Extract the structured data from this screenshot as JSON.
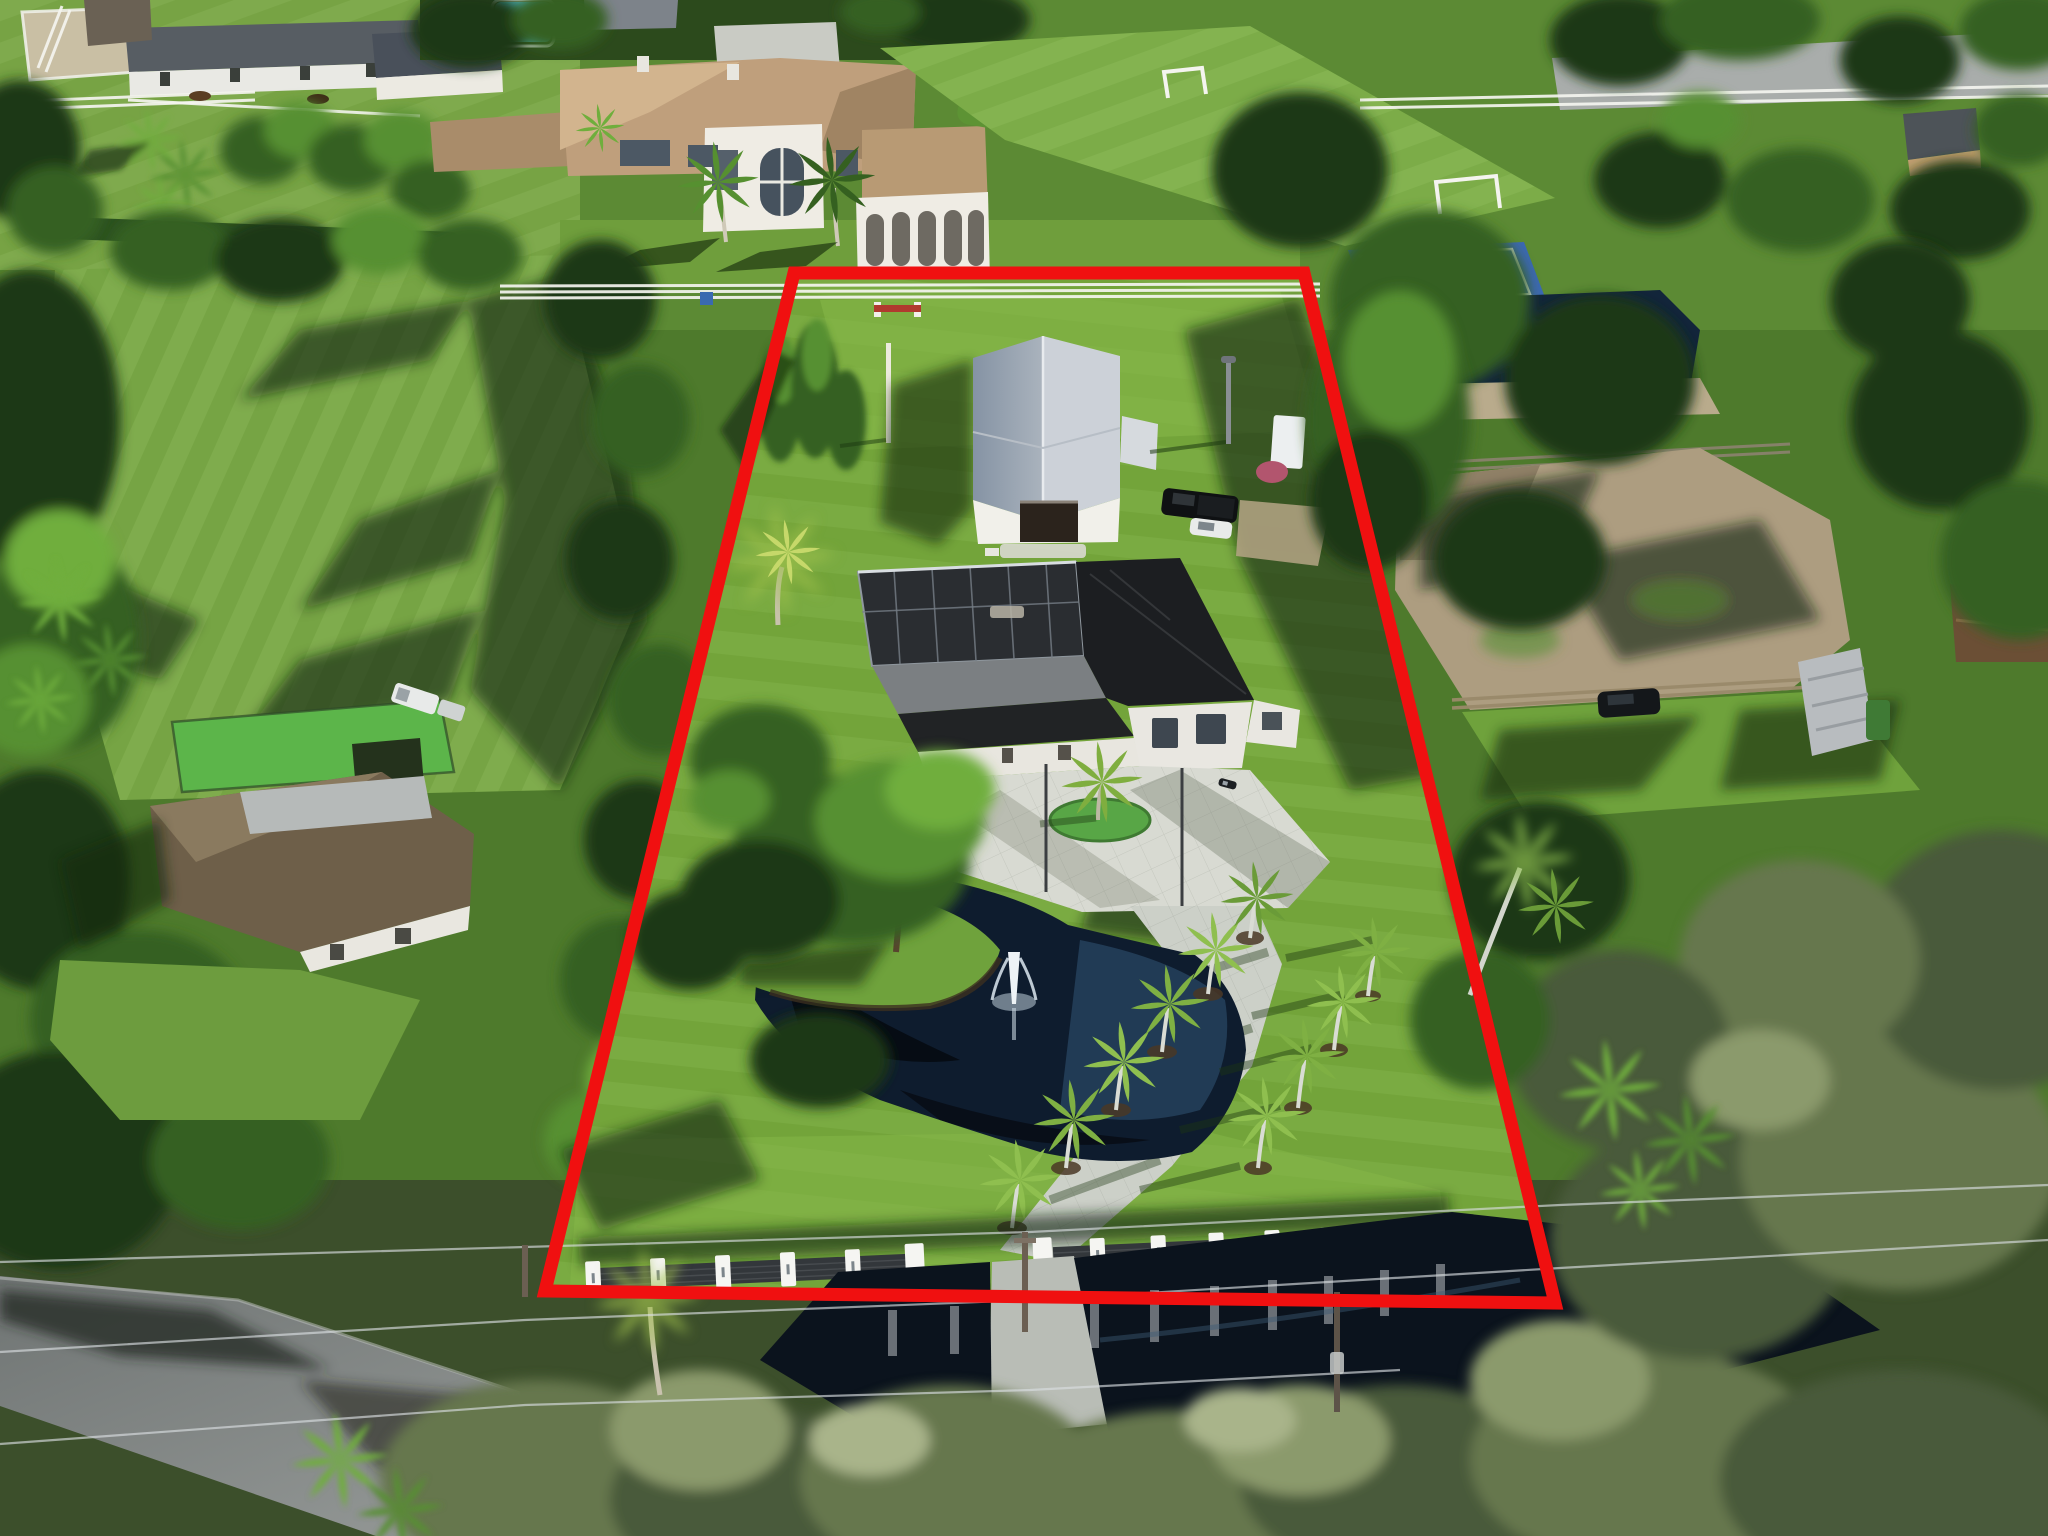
{
  "meta": {
    "title": "Aerial drone photograph of an equestrian estate lot outlined in red",
    "image_type": "real-estate aerial photo",
    "width_px": 2048,
    "height_px": 1536,
    "visible_text": "none"
  },
  "boundary": {
    "label": "property-boundary-outline",
    "color": "#f01010",
    "stroke_width": 13,
    "points": "794,273 1304,273 1555,1303 545,1291"
  },
  "colors": {
    "lawn": "#76a83c",
    "lawnBright": "#8abd4d",
    "fieldGreen": "#7aa946",
    "shadowGreen": "#1c3a12",
    "treeDark": "#1e3812",
    "treeMid": "#356020",
    "treeLight": "#569030",
    "scrubSage": "#66754e",
    "pond": "#0e1c2e",
    "pondLight": "#27445f",
    "canal": "#0b131d",
    "barnRoofLight": "#ccd1d8",
    "barnRoofShade": "#8f9cab",
    "whiteWall": "#f1f0ea",
    "houseRoof": "#1c1e21",
    "screenEnclosure": "#2a2d31",
    "courtBlue": "#3c68b4",
    "paddockDirt": "#ad9d80",
    "mansionRoof": "#bf9f7c",
    "mansionRoofShade": "#a08463",
    "poolWater": "#4fc0d8",
    "paver": "#d8dad2",
    "road": "#8e9392",
    "fencePanel": "#33373b",
    "fountainWhite": "#eef3f6"
  },
  "scene": {
    "description": "Sunlit aerial view of a rectangular estate lot outlined in red. Inside the lot: a white barn with a silver gable metal roof, a modern single-story house with a black roof and dark pool screen enclosure, a white paver courtyard and driveway lined with royal palms, an irregular pond with a fountain and an oak-topped grass peninsula, and a modern entry fence of white piers with dark slat panels along a canal and road.",
    "features": [
      {
        "name": "property-boundary",
        "label": "red outlined lot boundary"
      },
      {
        "name": "subject-barn",
        "label": "white barn with silver gable metal roof and open door"
      },
      {
        "name": "subject-house",
        "label": "modern house with black roof"
      },
      {
        "name": "pool-screen-enclosure",
        "label": "dark screened pool cage attached to house"
      },
      {
        "name": "courtyard",
        "label": "white paver motor court with turf island palm"
      },
      {
        "name": "driveway",
        "label": "concrete drive from entry gate to courtyard"
      },
      {
        "name": "pond",
        "label": "dark pond with fountain jet"
      },
      {
        "name": "fountain",
        "label": "white fountain spray"
      },
      {
        "name": "oak-peninsula",
        "label": "grass peninsula with large oak"
      },
      {
        "name": "royal-palm-rows",
        "label": "royal and coconut palms lining the drive"
      },
      {
        "name": "front-fence",
        "label": "modern fence, white piers with dark slats"
      },
      {
        "name": "entry-gate",
        "label": "gate opening at driveway"
      },
      {
        "name": "back-fence",
        "label": "white 3-rail pasture fence along rear line"
      },
      {
        "name": "horse-jump",
        "label": "small red and white jump in back pasture"
      },
      {
        "name": "black-pickup",
        "label": "black pickup truck beside barn"
      },
      {
        "name": "white-car",
        "label": "white car beside barn"
      },
      {
        "name": "motorcycle",
        "label": "motorcycle on courtyard"
      },
      {
        "name": "light-pole",
        "label": "area light pole near barn"
      },
      {
        "name": "norfolk-pines",
        "label": "Norfolk pines along west line"
      },
      {
        "name": "coconut-palm-west",
        "label": "bright coconut palm on west line"
      },
      {
        "name": "neighbor-mansion",
        "label": "tan tile-roof mansion with arched loggia and pool"
      },
      {
        "name": "soccer-field",
        "label": "private soccer field with white goals"
      },
      {
        "name": "basketball-court",
        "label": "blue basketball court"
      },
      {
        "name": "horse-farm",
        "label": "stable barns, riding ring, paddocks with horses"
      },
      {
        "name": "left-house",
        "label": "brown-roof neighbor house with turf yard"
      },
      {
        "name": "white-pickup-trailer",
        "label": "white pickup with trailer"
      },
      {
        "name": "ne-pond",
        "label": "neighbor pond beyond rear fence"
      },
      {
        "name": "dirt-paddock",
        "label": "sandy paddock with wood rail fence"
      },
      {
        "name": "dark-suv",
        "label": "dark SUV parked by paddock"
      },
      {
        "name": "tarp-boat",
        "label": "gray tarp-covered boat/shed"
      },
      {
        "name": "brown-shed",
        "label": "brown-roof shed far right"
      },
      {
        "name": "canal",
        "label": "dark drainage canal reflecting fence piers"
      },
      {
        "name": "road",
        "label": "asphalt road lower-left"
      },
      {
        "name": "power-lines",
        "label": "overhead utility wires and poles"
      },
      {
        "name": "scrub-trees",
        "label": "sage-green scrub tree band along road"
      },
      {
        "name": "banana-plants",
        "label": "bright banana foliage clusters"
      }
    ]
  }
}
